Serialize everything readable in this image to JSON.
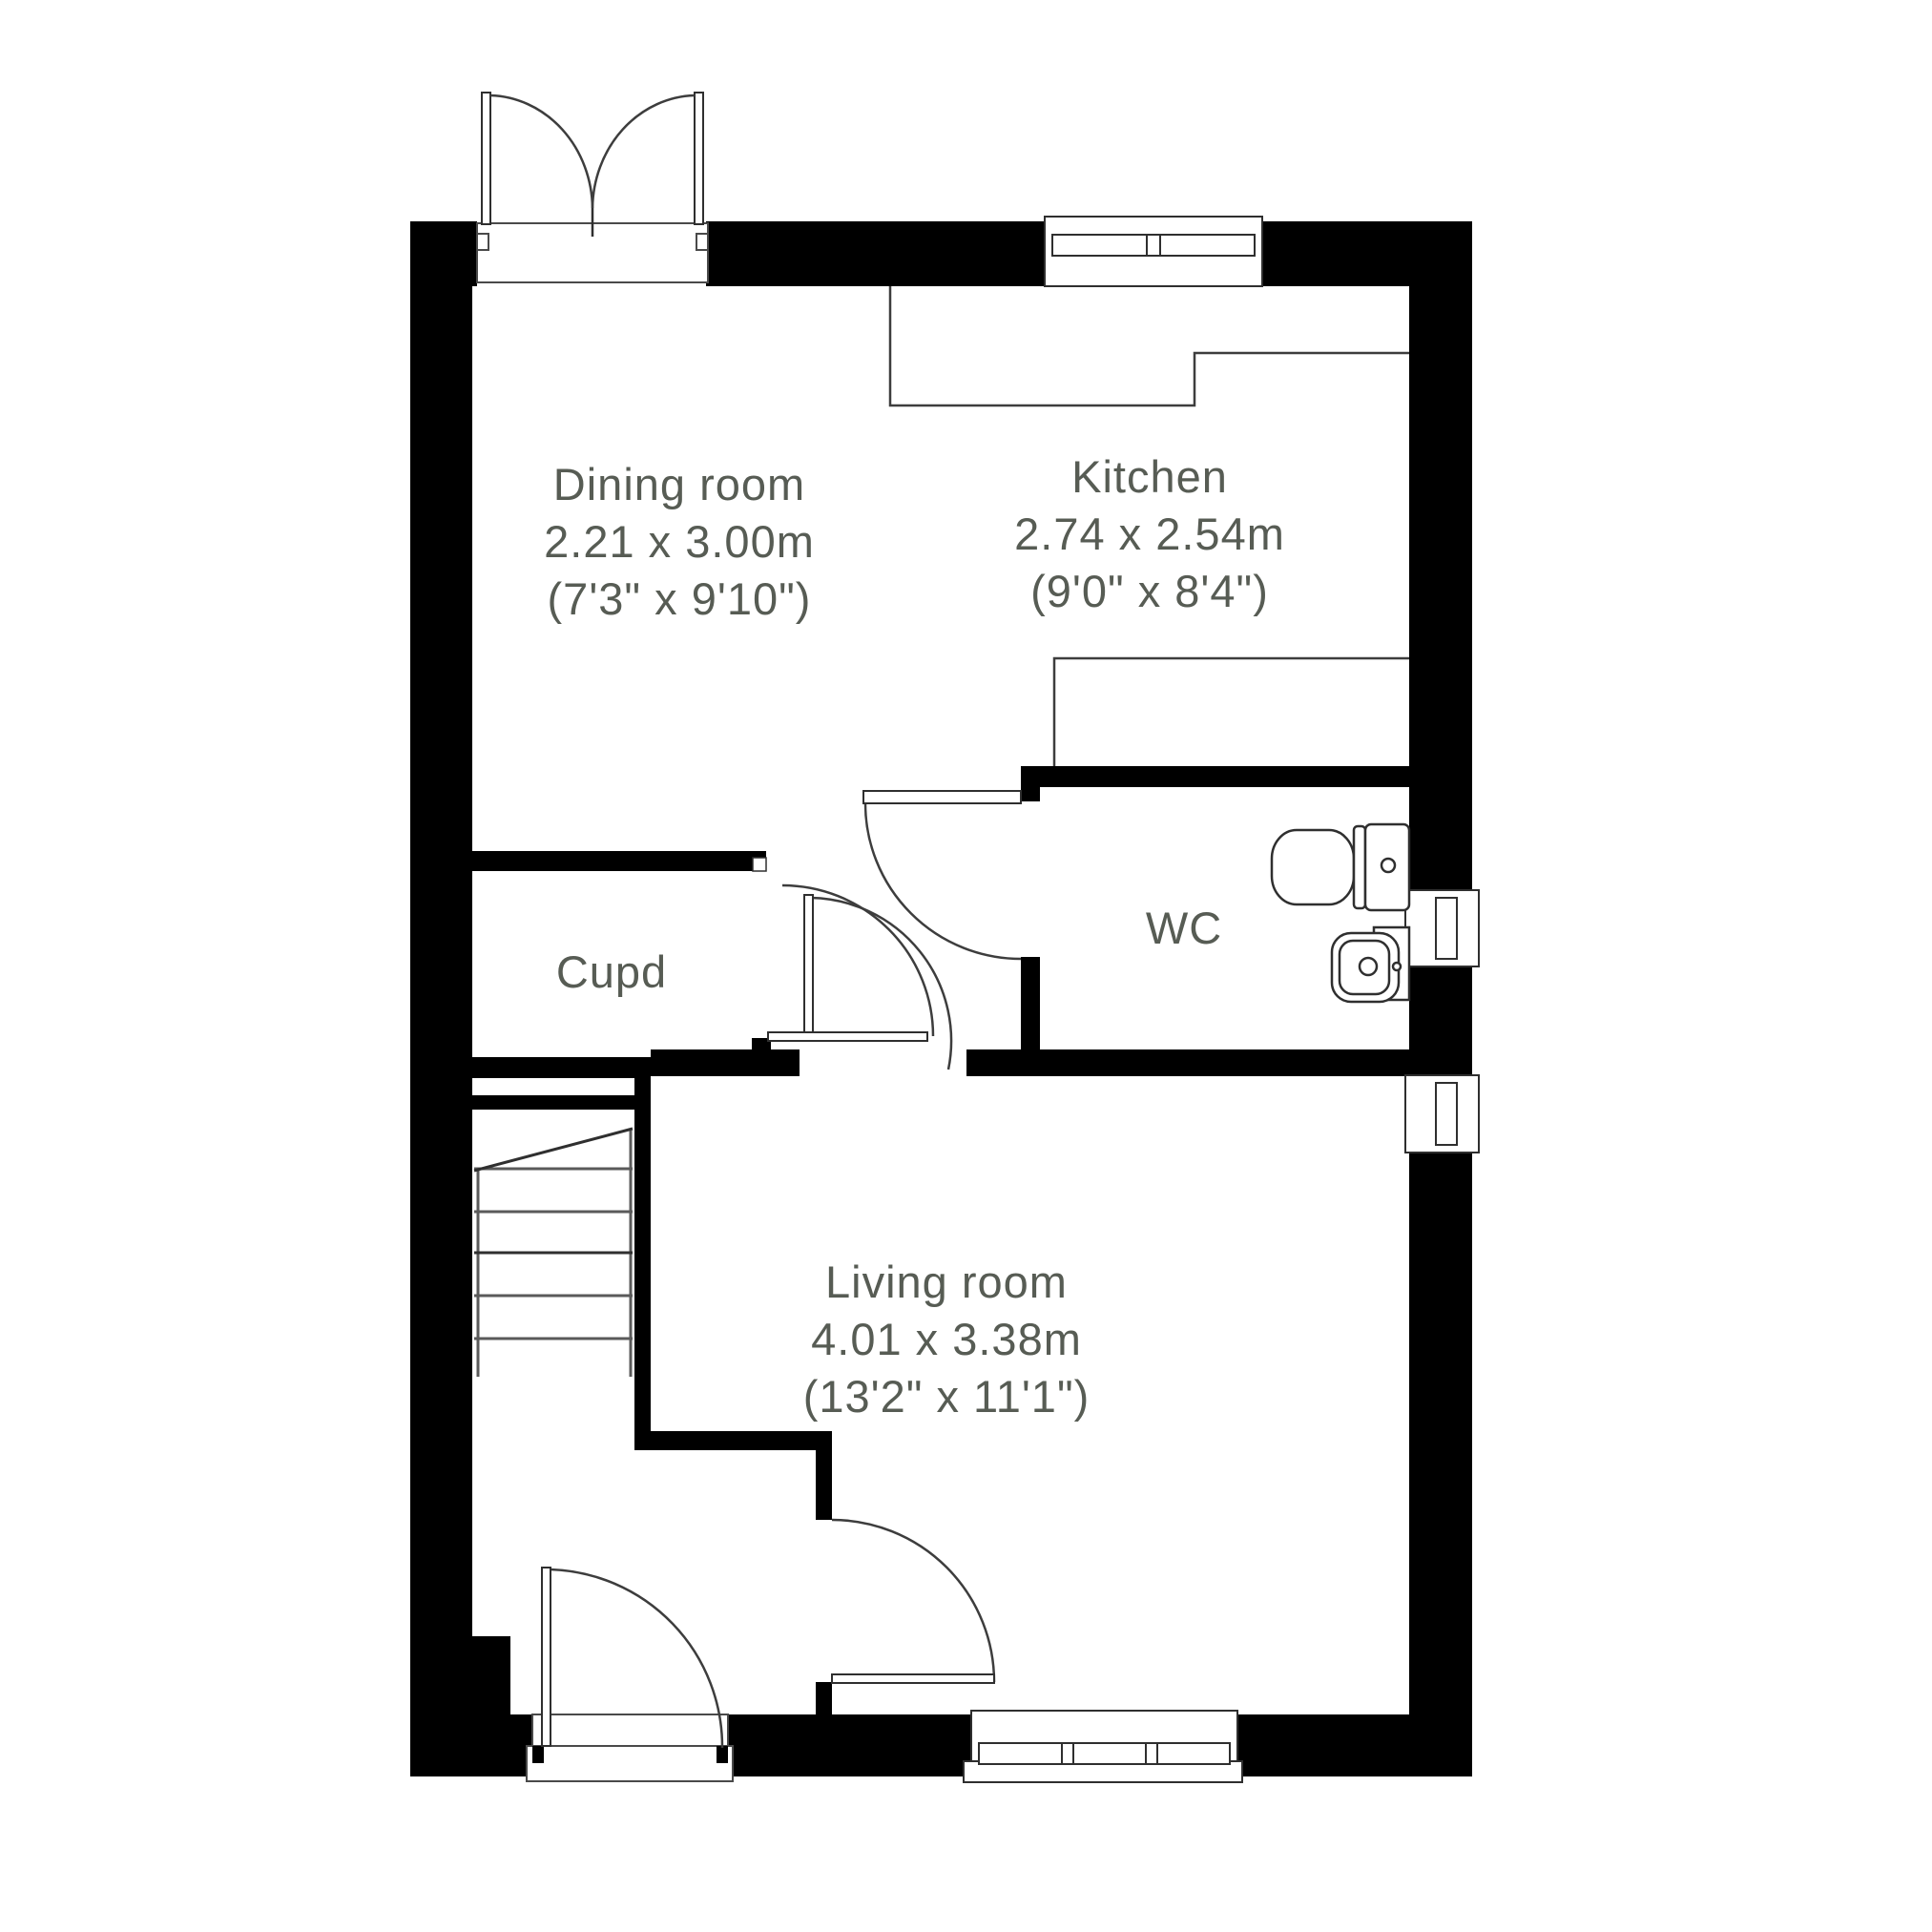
{
  "plan": {
    "title": "Ground floor plan",
    "colors": {
      "wall": "#000000",
      "line": "#3d3d3d",
      "thin_line": "#555555",
      "text": "#575c54",
      "floor": "#ffffff"
    },
    "rooms": {
      "dining": {
        "name": "Dining room",
        "metric": "2.21 x 3.00m",
        "imperial": "(7'3\" x 9'10\")"
      },
      "kitchen": {
        "name": "Kitchen",
        "metric": "2.74 x 2.54m",
        "imperial": "(9'0\" x 8'4\")"
      },
      "cupboard": {
        "name": "Cupd"
      },
      "wc": {
        "name": "WC"
      },
      "living": {
        "name": "Living room",
        "metric": "4.01 x 3.38m",
        "imperial": "(13'2\" x 11'1\")"
      }
    },
    "fixtures": [
      {
        "name": "toilet"
      },
      {
        "name": "wash-basin"
      },
      {
        "name": "staircase"
      }
    ],
    "openings": [
      {
        "name": "french-doors",
        "wall": "top"
      },
      {
        "name": "window",
        "wall": "top"
      },
      {
        "name": "window",
        "wall": "right-upper"
      },
      {
        "name": "window",
        "wall": "right-lower"
      },
      {
        "name": "window",
        "wall": "bottom"
      },
      {
        "name": "front-door",
        "wall": "bottom"
      },
      {
        "name": "wc-door",
        "wall": "hall"
      },
      {
        "name": "dining-hall-door",
        "wall": "hall"
      },
      {
        "name": "living-room-door-north",
        "wall": "hall"
      },
      {
        "name": "living-room-door-west",
        "wall": "entrance-hall"
      }
    ]
  }
}
